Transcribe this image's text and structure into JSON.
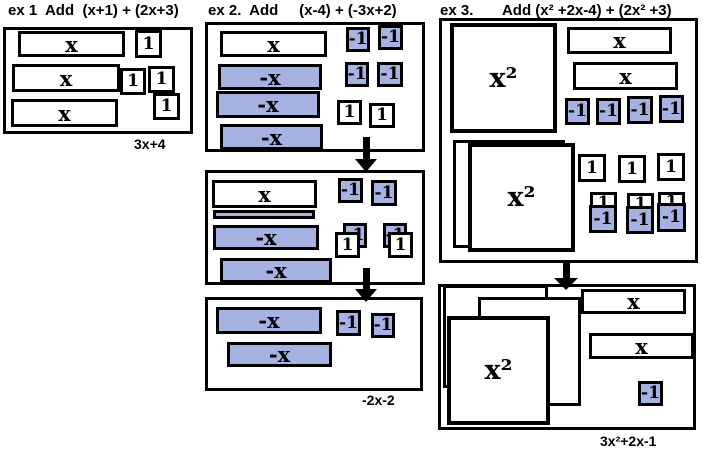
{
  "colors": {
    "tile_blue": "#a6b2e2",
    "ink": "#000000",
    "background": "#ffffff"
  },
  "examples": [
    {
      "id": "ex1",
      "title": "ex 1  Add  (x+1) + (2x+3)",
      "result": "3x+4"
    },
    {
      "id": "ex2",
      "title": "ex 2.  Add     (x-4) + (-3x+2)",
      "result": "-2x-2"
    },
    {
      "id": "ex3",
      "title": "ex 3.       Add (x² +2x-4) + (2x² +3)",
      "result": "3x²+2x-1"
    }
  ],
  "tile_labels": {
    "x": "x",
    "neg-x": "-x",
    "one": "1",
    "neg-one": "-1",
    "x2": "x²",
    "blank": "",
    "strip": ""
  },
  "panels": [
    {
      "name": "ex1-box",
      "x": 3,
      "y": 27,
      "w": 190,
      "h": 107
    },
    {
      "name": "ex2-step1",
      "x": 205,
      "y": 22,
      "w": 220,
      "h": 130
    },
    {
      "name": "ex2-step2",
      "x": 205,
      "y": 170,
      "w": 220,
      "h": 115
    },
    {
      "name": "ex2-step3",
      "x": 205,
      "y": 297,
      "w": 218,
      "h": 94
    },
    {
      "name": "ex3-step1",
      "x": 439,
      "y": 18,
      "w": 259,
      "h": 245
    },
    {
      "name": "ex3-step2",
      "x": 438,
      "y": 284,
      "w": 258,
      "h": 146
    }
  ],
  "arrows": [
    {
      "name": "ex2-arrow-1",
      "x": 366,
      "top": 137,
      "shaft": 22,
      "headw": 22,
      "headh": 13
    },
    {
      "name": "ex2-arrow-2",
      "x": 366,
      "top": 268,
      "shaft": 21,
      "headw": 22,
      "headh": 13
    },
    {
      "name": "ex3-arrow-1",
      "x": 566,
      "top": 262,
      "shaft": 16,
      "headw": 24,
      "headh": 12
    }
  ],
  "tiles": [
    {
      "ex": "ex1",
      "type": "x",
      "x": 18,
      "y": 31,
      "w": 107,
      "h": 26
    },
    {
      "ex": "ex1",
      "type": "one",
      "x": 135,
      "y": 30,
      "w": 27,
      "h": 28
    },
    {
      "ex": "ex1",
      "type": "x",
      "x": 12,
      "y": 64,
      "w": 108,
      "h": 28
    },
    {
      "ex": "ex1",
      "type": "one",
      "x": 120,
      "y": 68,
      "w": 26,
      "h": 27
    },
    {
      "ex": "ex1",
      "type": "one",
      "x": 148,
      "y": 66,
      "w": 27,
      "h": 27
    },
    {
      "ex": "ex1",
      "type": "one",
      "x": 153,
      "y": 93,
      "w": 27,
      "h": 27
    },
    {
      "ex": "ex1",
      "type": "x",
      "x": 11,
      "y": 99,
      "w": 107,
      "h": 28
    },
    {
      "ex": "ex2a",
      "type": "x",
      "x": 220,
      "y": 31,
      "w": 107,
      "h": 26
    },
    {
      "ex": "ex2a",
      "type": "neg-x",
      "x": 218,
      "y": 64,
      "w": 104,
      "h": 26
    },
    {
      "ex": "ex2a",
      "type": "neg-x",
      "x": 216,
      "y": 91,
      "w": 104,
      "h": 27
    },
    {
      "ex": "ex2a",
      "type": "neg-x",
      "x": 220,
      "y": 124,
      "w": 103,
      "h": 26
    },
    {
      "ex": "ex2a",
      "type": "neg-one",
      "x": 346,
      "y": 27,
      "w": 24,
      "h": 25
    },
    {
      "ex": "ex2a",
      "type": "neg-one",
      "x": 378,
      "y": 25,
      "w": 25,
      "h": 25
    },
    {
      "ex": "ex2a",
      "type": "neg-one",
      "x": 345,
      "y": 62,
      "w": 24,
      "h": 25
    },
    {
      "ex": "ex2a",
      "type": "neg-one",
      "x": 377,
      "y": 62,
      "w": 26,
      "h": 25
    },
    {
      "ex": "ex2a",
      "type": "one",
      "x": 337,
      "y": 100,
      "w": 25,
      "h": 25
    },
    {
      "ex": "ex2a",
      "type": "one",
      "x": 369,
      "y": 103,
      "w": 26,
      "h": 25
    },
    {
      "ex": "ex2b",
      "type": "x",
      "x": 212,
      "y": 180,
      "w": 105,
      "h": 28
    },
    {
      "ex": "ex2b",
      "type": "strip",
      "x": 213,
      "y": 210,
      "w": 102,
      "h": 9
    },
    {
      "ex": "ex2b",
      "type": "neg-x",
      "x": 213,
      "y": 225,
      "w": 106,
      "h": 25
    },
    {
      "ex": "ex2b",
      "type": "neg-x",
      "x": 220,
      "y": 258,
      "w": 112,
      "h": 25
    },
    {
      "ex": "ex2b",
      "type": "neg-one",
      "x": 338,
      "y": 178,
      "w": 25,
      "h": 25
    },
    {
      "ex": "ex2b",
      "type": "neg-one",
      "x": 371,
      "y": 180,
      "w": 26,
      "h": 26
    },
    {
      "ex": "ex2b",
      "type": "neg-one",
      "x": 343,
      "y": 223,
      "w": 24,
      "h": 25
    },
    {
      "ex": "ex2b",
      "type": "one",
      "x": 335,
      "y": 232,
      "w": 25,
      "h": 26
    },
    {
      "ex": "ex2b",
      "type": "neg-one",
      "x": 383,
      "y": 223,
      "w": 24,
      "h": 25
    },
    {
      "ex": "ex2b",
      "type": "one",
      "x": 388,
      "y": 232,
      "w": 25,
      "h": 26
    },
    {
      "ex": "ex2c",
      "type": "neg-x",
      "x": 216,
      "y": 307,
      "w": 106,
      "h": 27
    },
    {
      "ex": "ex2c",
      "type": "neg-x",
      "x": 227,
      "y": 342,
      "w": 105,
      "h": 25
    },
    {
      "ex": "ex2c",
      "type": "neg-one",
      "x": 336,
      "y": 310,
      "w": 25,
      "h": 26
    },
    {
      "ex": "ex2c",
      "type": "neg-one",
      "x": 371,
      "y": 313,
      "w": 24,
      "h": 25
    },
    {
      "ex": "ex3a",
      "type": "x2",
      "x": 450,
      "y": 23,
      "w": 107,
      "h": 110
    },
    {
      "ex": "ex3a",
      "type": "x",
      "x": 567,
      "y": 27,
      "w": 105,
      "h": 27
    },
    {
      "ex": "ex3a",
      "type": "x",
      "x": 573,
      "y": 62,
      "w": 105,
      "h": 28
    },
    {
      "ex": "ex3a",
      "type": "neg-one",
      "x": 565,
      "y": 98,
      "w": 25,
      "h": 27
    },
    {
      "ex": "ex3a",
      "type": "neg-one",
      "x": 596,
      "y": 98,
      "w": 25,
      "h": 27
    },
    {
      "ex": "ex3a",
      "type": "neg-one",
      "x": 627,
      "y": 96,
      "w": 26,
      "h": 28
    },
    {
      "ex": "ex3a",
      "type": "neg-one",
      "x": 659,
      "y": 95,
      "w": 25,
      "h": 28
    },
    {
      "ex": "ex3a",
      "type": "blank",
      "x": 453,
      "y": 140,
      "w": 112,
      "h": 108
    },
    {
      "ex": "ex3a",
      "type": "x2",
      "x": 468,
      "y": 143,
      "w": 107,
      "h": 109
    },
    {
      "ex": "ex3a",
      "type": "one",
      "x": 578,
      "y": 154,
      "w": 28,
      "h": 28
    },
    {
      "ex": "ex3a",
      "type": "one",
      "x": 618,
      "y": 155,
      "w": 28,
      "h": 28
    },
    {
      "ex": "ex3a",
      "type": "one",
      "x": 657,
      "y": 153,
      "w": 28,
      "h": 28
    },
    {
      "ex": "ex3a",
      "type": "one",
      "x": 590,
      "y": 192,
      "w": 27,
      "h": 22
    },
    {
      "ex": "ex3a",
      "type": "neg-one",
      "x": 589,
      "y": 205,
      "w": 28,
      "h": 28
    },
    {
      "ex": "ex3a",
      "type": "one",
      "x": 627,
      "y": 193,
      "w": 27,
      "h": 22
    },
    {
      "ex": "ex3a",
      "type": "neg-one",
      "x": 626,
      "y": 206,
      "w": 28,
      "h": 28
    },
    {
      "ex": "ex3a",
      "type": "one",
      "x": 658,
      "y": 192,
      "w": 27,
      "h": 21
    },
    {
      "ex": "ex3a",
      "type": "neg-one",
      "x": 657,
      "y": 203,
      "w": 29,
      "h": 29
    },
    {
      "ex": "ex3b",
      "type": "blank",
      "x": 443,
      "y": 285,
      "w": 105,
      "h": 103
    },
    {
      "ex": "ex3b",
      "type": "blank",
      "x": 478,
      "y": 297,
      "w": 103,
      "h": 109
    },
    {
      "ex": "ex3b",
      "type": "x2",
      "x": 447,
      "y": 316,
      "w": 103,
      "h": 109
    },
    {
      "ex": "ex3b",
      "type": "x",
      "x": 581,
      "y": 289,
      "w": 105,
      "h": 25
    },
    {
      "ex": "ex3b",
      "type": "x",
      "x": 589,
      "y": 333,
      "w": 105,
      "h": 26
    },
    {
      "ex": "ex3b",
      "type": "neg-one",
      "x": 638,
      "y": 381,
      "w": 25,
      "h": 25
    }
  ]
}
